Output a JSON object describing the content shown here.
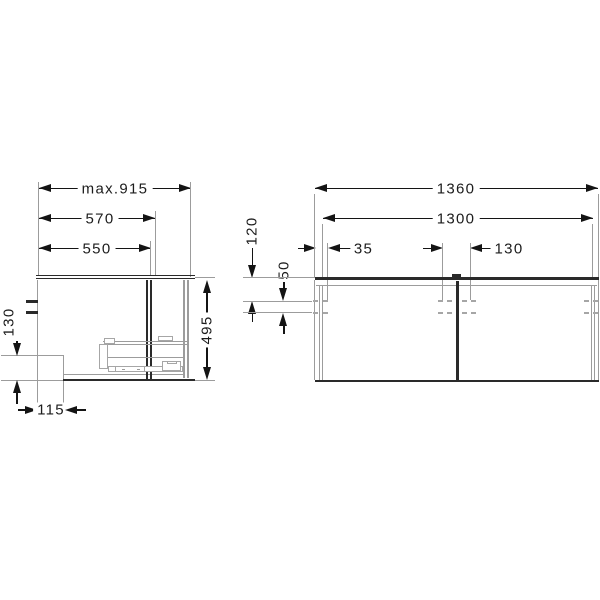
{
  "drawing": {
    "title": "vanity unit dimension drawing",
    "side_view": {
      "labels": {
        "max_depth": "max.915",
        "depth_outer": "570",
        "depth_inner": "550",
        "height": "495",
        "recess_height": "130",
        "recess_depth": "115"
      }
    },
    "front_view": {
      "labels": {
        "total_width": "1360",
        "inner_width": "1300",
        "edge_to_hole": "35",
        "center_hole_spacing": "130",
        "top_to_first_hole": "120",
        "hole_row_gap": "50"
      }
    },
    "colors": {
      "object_dark": "#2a2a2a",
      "object_light": "#a6a6a6",
      "dim_line": "#141414",
      "ext_line": "#9c9c9c",
      "label_text": "#1c1c1c",
      "background": "#ffffff"
    }
  }
}
